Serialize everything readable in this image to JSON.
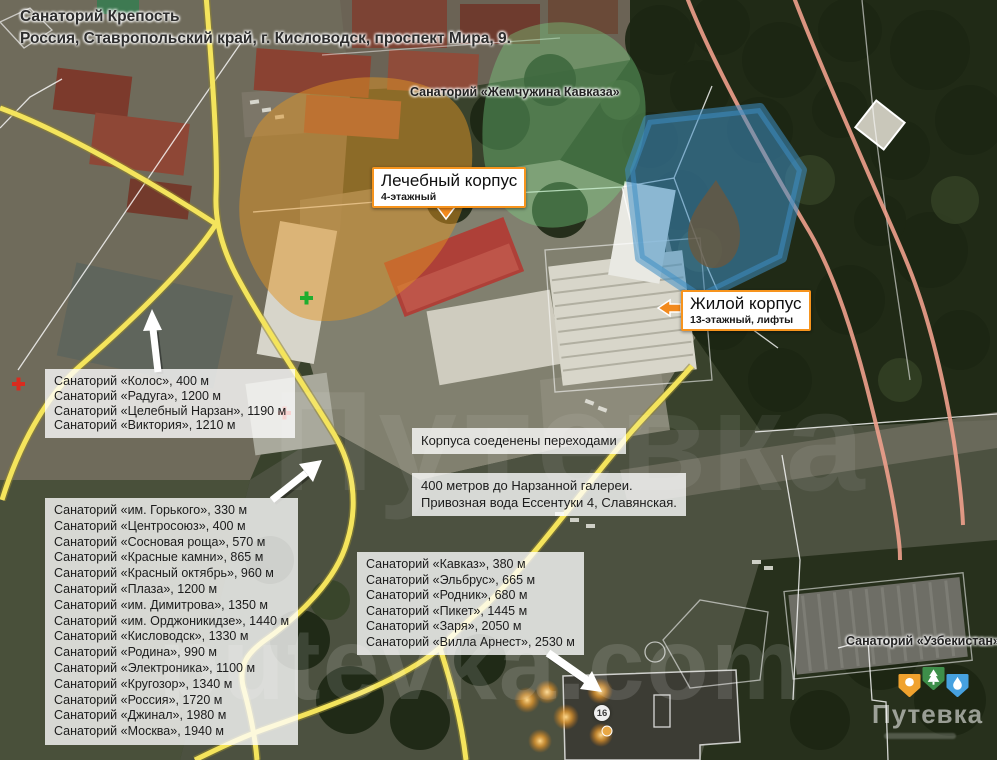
{
  "header": {
    "line1": "Санаторий Крепость",
    "line2": "Россия, Ставропольский край, г. Кисловодск, проспект Мира, 9."
  },
  "labels": {
    "pearl": "Санаторий «Жемчужина Кавказа»",
    "uzbekistan": "Санаторий «Узбекистан»"
  },
  "callouts": {
    "medical": {
      "title": "Лечебный корпус",
      "subtitle": "4-этажный"
    },
    "residential": {
      "title": "Жилой корпус",
      "subtitle": "13-этажный, лифты"
    }
  },
  "notes": {
    "connected": "Корпуса соеденены переходами",
    "narzan_line1": "400 метров до Нарзанной галереи.",
    "narzan_line2": "Привозная вода Ессентуки 4, Славянская."
  },
  "nearby_west": {
    "items": [
      "Санаторий «Колос», 400 м",
      "Санаторий «Радуга», 1200 м",
      "Санаторий «Целебный Нарзан», 1190 м",
      "Санаторий «Виктория», 1210 м"
    ]
  },
  "nearby_main": {
    "items": [
      "Санаторий «им. Горького», 330 м",
      "Санаторий «Центросоюз», 400 м",
      "Санаторий «Сосновая роща», 570 м",
      "Санаторий «Красные камни», 865 м",
      "Санаторий «Красный октябрь», 960 м",
      "Санаторий «Плаза», 1200 м",
      "Санаторий «им. Димитрова», 1350 м",
      "Санаторий «им. Орджоникидзе», 1440 м",
      "Санаторий «Кисловодск», 1330 м",
      "Санаторий «Родина», 990 м",
      "Санаторий «Электроника», 1100 м",
      "Санаторий «Кругозор», 1340 м",
      "Санаторий «Россия», 1720 м",
      "Санаторий «Джинал», 1980 м",
      "Санаторий «Москва», 1940 м"
    ]
  },
  "nearby_south": {
    "items": [
      "Санаторий «Кавказ», 380 м",
      "Санаторий «Эльбрус», 665 м",
      "Санаторий «Родник», 680 м",
      "Санаторий «Пикет», 1445 м",
      "Санаторий «Заря», 2050 м",
      "Санаторий «Вилла Арнест», 2530 м"
    ]
  },
  "map": {
    "watermark_center": "Путевка",
    "watermark_bottom": "putevka.com",
    "route_badge": "16"
  },
  "logo": {
    "brand": "Путевка"
  },
  "colors": {
    "callout_border": "#f7941d",
    "overlay_orange": "rgba(224,148,35,0.5)",
    "overlay_green": "rgba(120,215,135,0.38)",
    "overlay_blue": "rgba(62,142,196,0.55)",
    "road_yellow": "#f4e45c",
    "road_pink": "#efa08c",
    "arrow_white": "#ffffff",
    "cross_red": "#d92b1f",
    "cross_green": "#1fae2e",
    "logo_orange": "#f0a22e",
    "logo_green": "#3e8f4a",
    "logo_blue": "#46a1e0"
  }
}
